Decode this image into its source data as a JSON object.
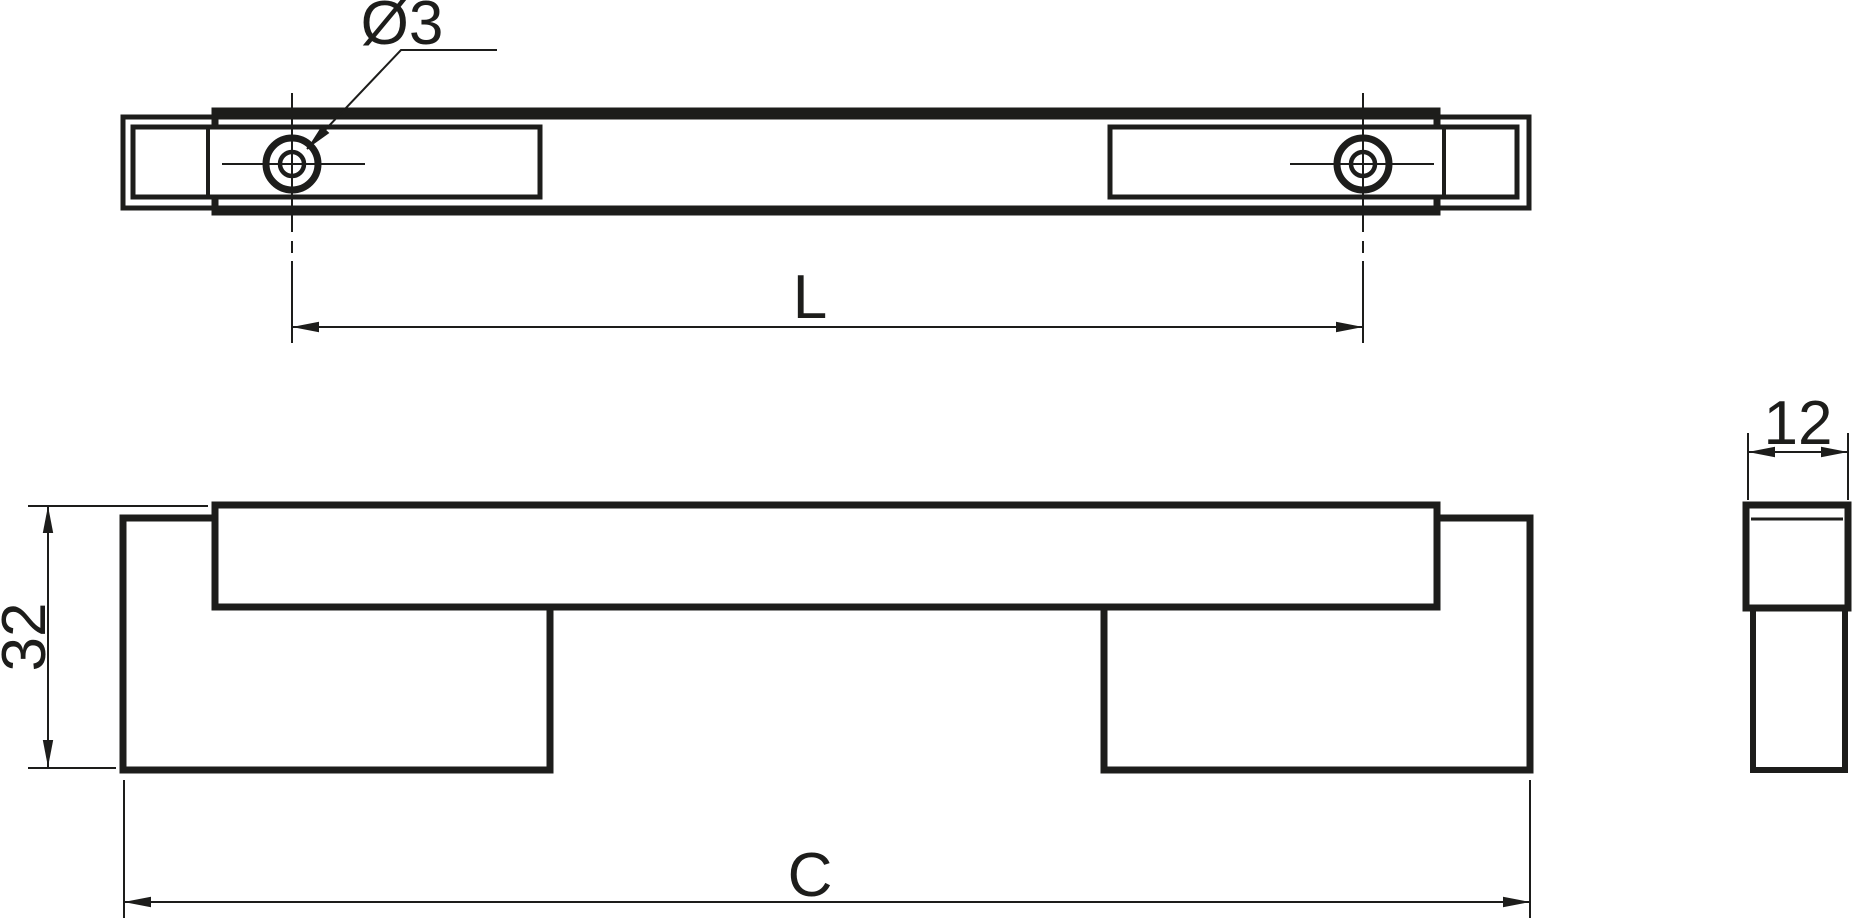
{
  "drawing": {
    "title": "Bar handle technical drawing, three orthographic views",
    "labels": {
      "hole_diameter": "Ø3",
      "hole_spacing": "L",
      "height": "32",
      "overall_length": "C",
      "depth": "12"
    },
    "colors": {
      "ink": "#1d1d1b",
      "background": "#ffffff"
    }
  }
}
